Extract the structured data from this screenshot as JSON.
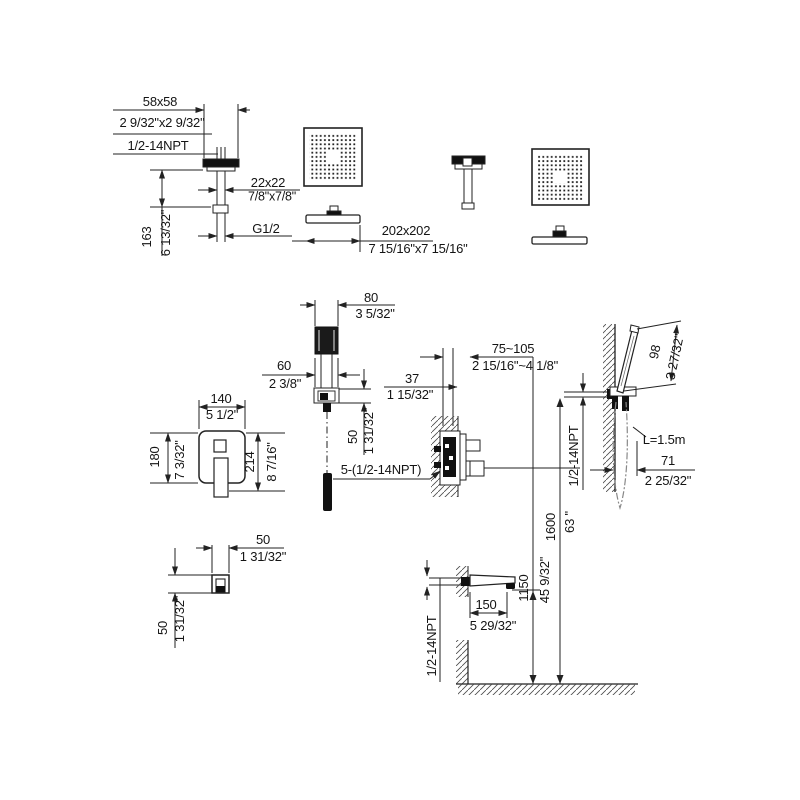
{
  "drawing": {
    "ceiling_arm": {
      "flange_mm": "58x58",
      "flange_in": "2 9/32\"x2 9/32\"",
      "thread": "1/2-14NPT",
      "pipe_mm": "22x22",
      "pipe_in": "7/8\"x7/8\"",
      "drop_mm": "163",
      "drop_in": "6 13/32\"",
      "outlet_thread": "G1/2"
    },
    "shower_head": {
      "size_mm": "202x202",
      "size_in": "7 15/16\"x7 15/16\""
    },
    "wall_outlet": {
      "width_mm": "80",
      "width_in": "3 5/32\"",
      "body_mm": "60",
      "body_in": "2 3/8\"",
      "depth_mm": "50",
      "depth_in": "1 31/32\"",
      "offset_mm": "37",
      "offset_in": "1 15/32\""
    },
    "valve_trim": {
      "width_mm": "140",
      "width_in": "5 1/2\"",
      "height_mm": "180",
      "height_in": "7 3/32\"",
      "total_height_mm": "214",
      "total_height_in": "8 7/16\""
    },
    "rough_in_valve": {
      "depth_range_mm": "75~105",
      "depth_range_in": "2 15/16\"~4 1/8\"",
      "connections": "5-(1/2-14NPT)"
    },
    "hand_shower": {
      "head_mm": "98",
      "head_in": "3 27/32\"",
      "hose_length": "L=1.5m",
      "offset_mm": "71",
      "offset_in": "2 25/32\"",
      "thread": "1/2-14NPT"
    },
    "supply_elbow": {
      "width_mm": "50",
      "width_in": "1 31/32\"",
      "height_mm": "50",
      "height_in": "1 31/32\""
    },
    "tub_spout": {
      "length_mm": "150",
      "length_in": "5 29/32\"",
      "thread": "1/2-14NPT"
    },
    "install_heights": {
      "valve_mm": "1600",
      "valve_in": "63 \"",
      "spout_mm": "1150",
      "spout_in": "45 9/32\""
    }
  }
}
